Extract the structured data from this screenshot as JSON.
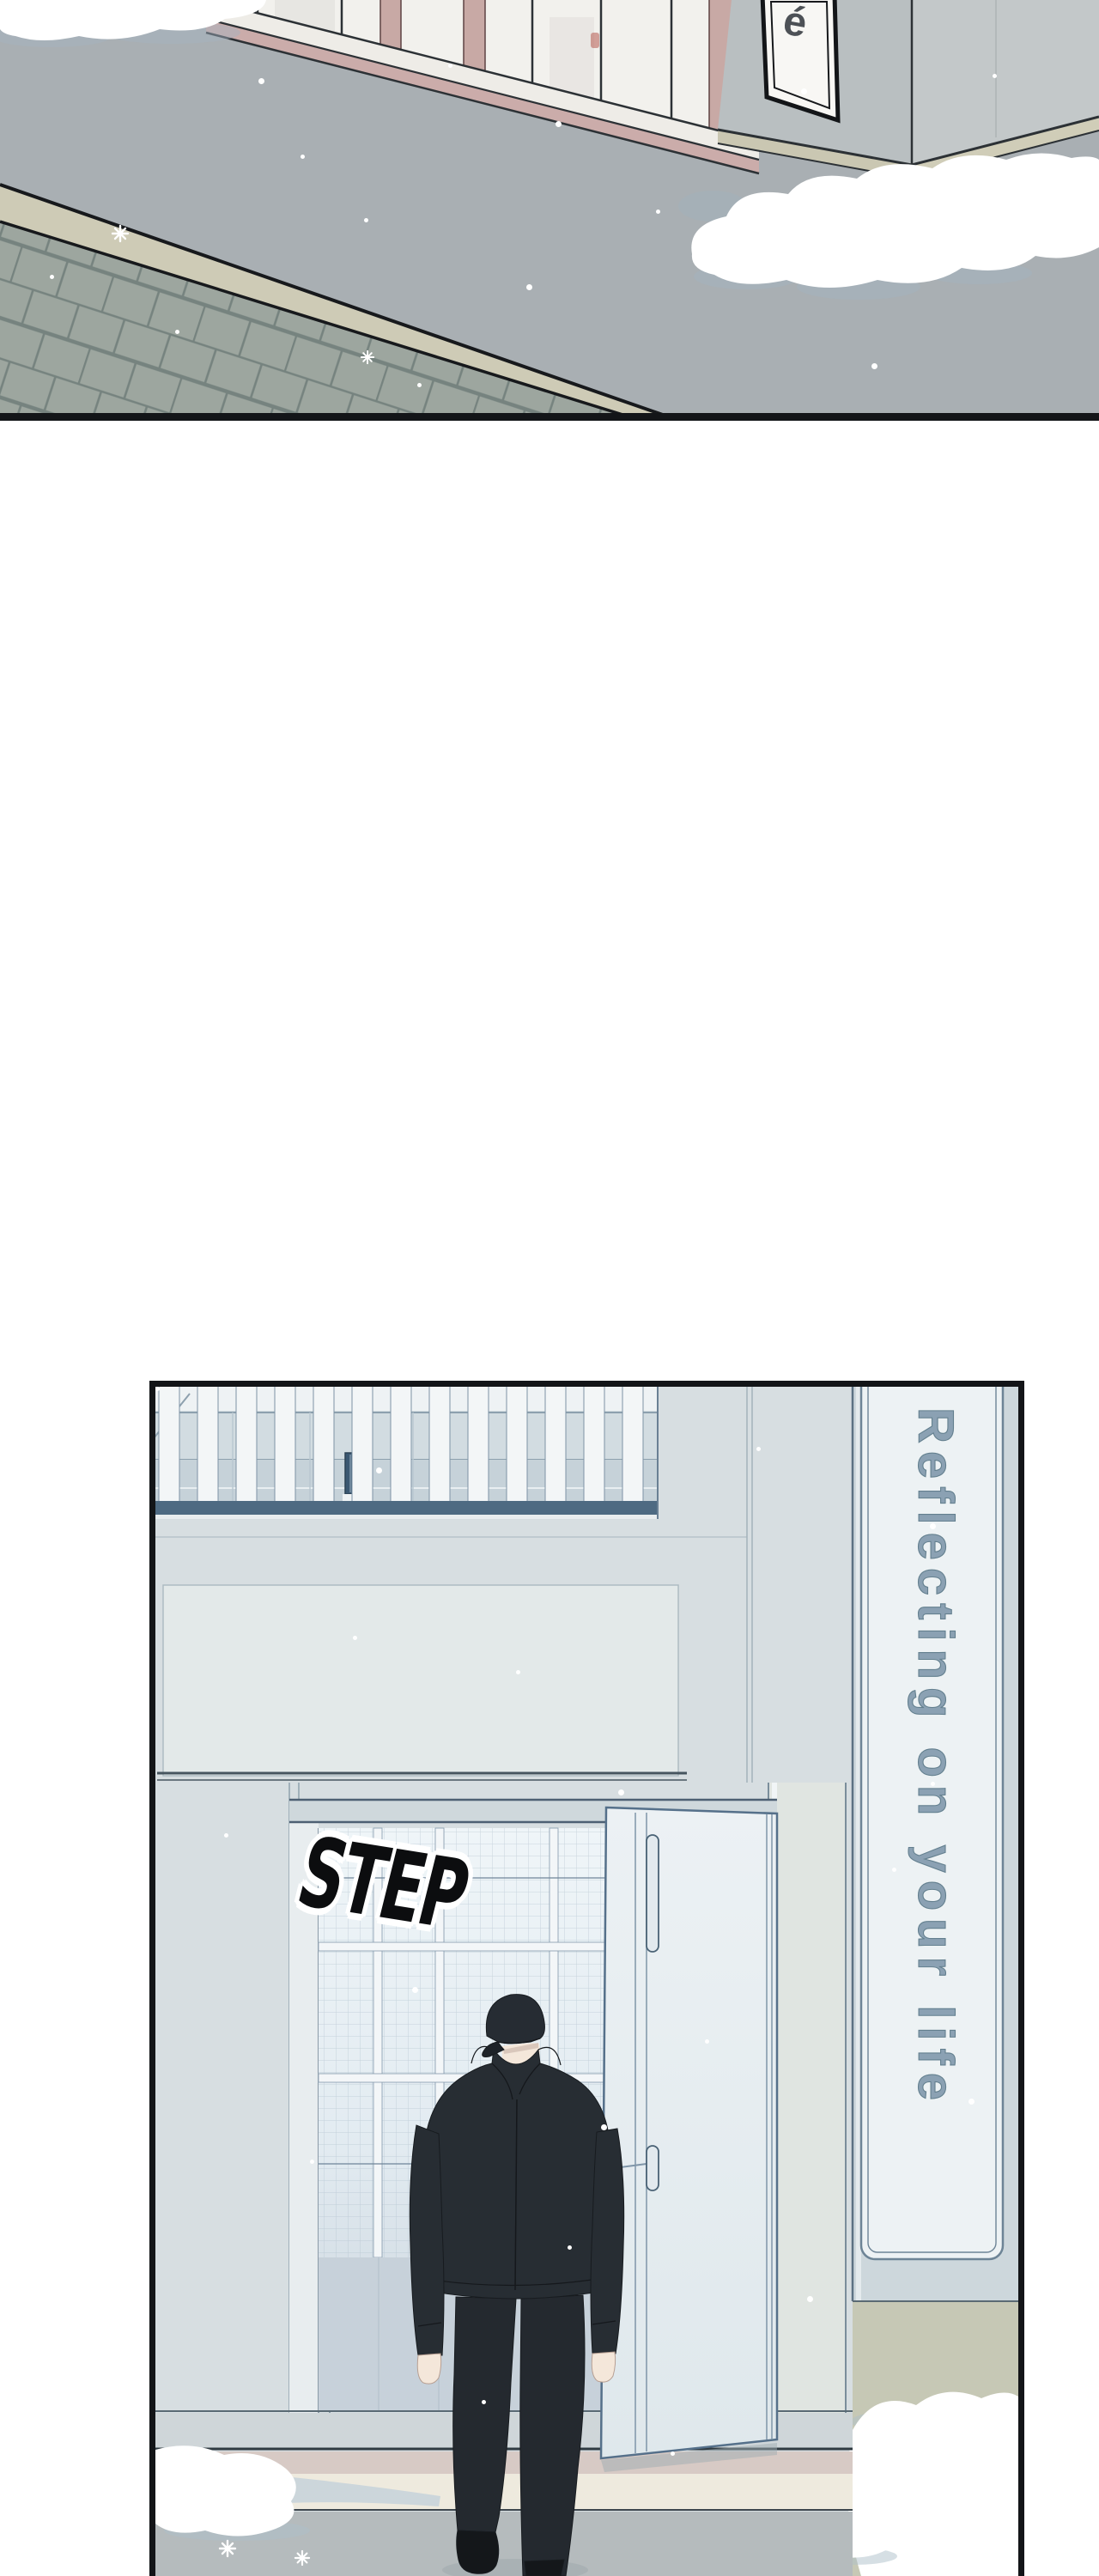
{
  "page": {
    "type": "webtoon episode segment",
    "background": "#ffffff"
  },
  "panel_top": {
    "cafe_sign": {
      "text": "é",
      "fill": "#f8f7f4",
      "border": "#131518",
      "letter_color": "#4d5156"
    },
    "palette": {
      "street": "#a9afb3",
      "cobblestone": "#9da69f",
      "curb": "#cecbb6",
      "building_left_face": "#b9bfc1",
      "building_right_face": "#c3c8c9",
      "window_mullion_pink": "#c8a9a5",
      "sill_white": "#eeece7",
      "snow": "#ffffff",
      "snow_shadow": "#a3b4c0",
      "outline": "#2c3135"
    }
  },
  "panel_bottom": {
    "sfx": {
      "text": "STEP",
      "fill": "#0c0d0f",
      "outline": "#ffffff"
    },
    "vertical_sign": {
      "text": "Reflecting on your life",
      "color": "#8ba1b3",
      "panel_fill": "#edf2f4",
      "frame": "#6d8496"
    },
    "palette": {
      "wall": "#d7dee1",
      "fascia": "#e3e9e9",
      "railing_slat": "#f3f6f7",
      "railing_rail": "#4e6a82",
      "sign_wall": "#cdd7dc",
      "door": "#e9eff2",
      "interior_top": "#eff5f8",
      "interior_bottom": "#c9d3dc",
      "figure_outfit": "#272d33",
      "skin": "#f4e7da",
      "sidewalk_tan": "#c6c8b5",
      "ground": "#b5bbbd",
      "pink_band": "#d7cac5",
      "cream_band": "#eeeade",
      "border": "#131518"
    }
  }
}
